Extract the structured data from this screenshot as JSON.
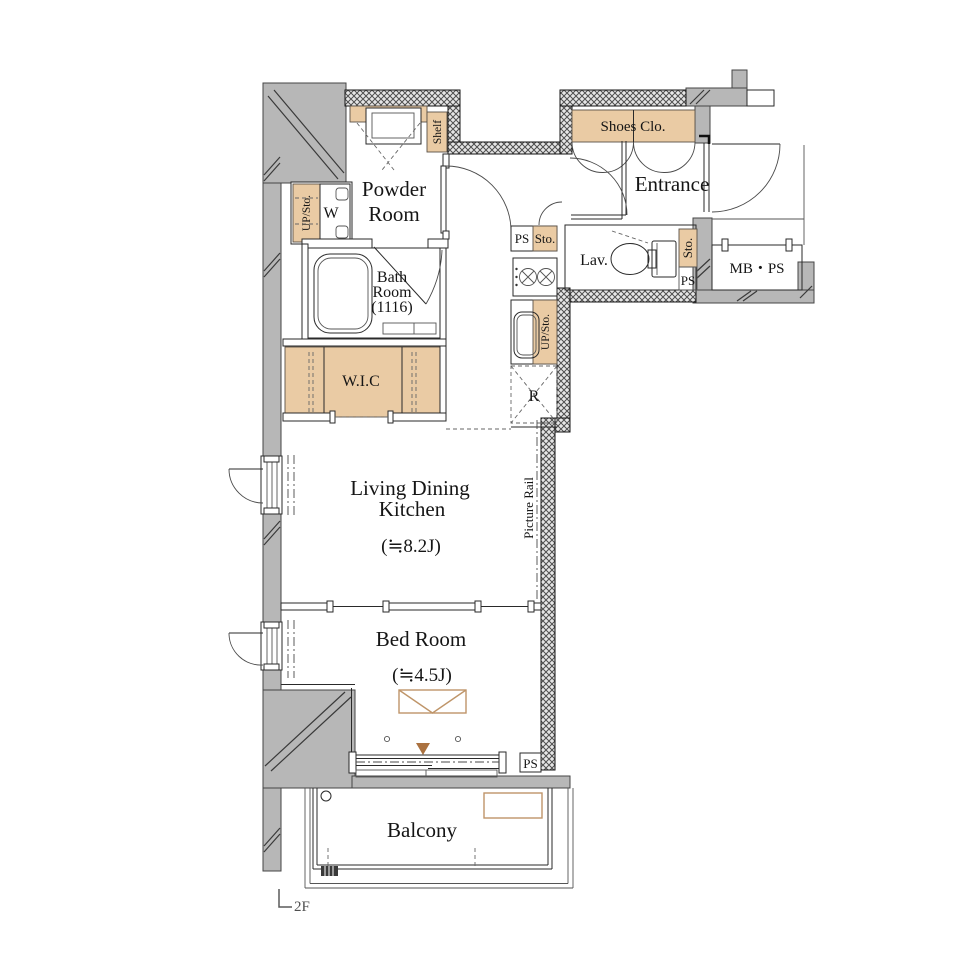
{
  "plan": {
    "floor_label": "2F",
    "rooms": {
      "powder": {
        "l1": "Powder",
        "l2": "Room"
      },
      "bath": {
        "l1": "Bath",
        "l2": "Room",
        "l3": "(1116)"
      },
      "wic": {
        "label": "W.I.C"
      },
      "ldk": {
        "l1": "Living Dining",
        "l2": "Kitchen",
        "size": "(≒8.2J)"
      },
      "bed": {
        "label": "Bed Room",
        "size": "(≒4.5J)"
      },
      "balcony": {
        "label": "Balcony"
      },
      "entrance": {
        "label": "Entrance"
      },
      "lav": {
        "label": "Lav."
      },
      "shoes": {
        "label": "Shoes Clo."
      },
      "mbps": {
        "label": "MB・PS"
      }
    },
    "fixtures": {
      "shelf": "Shelf",
      "laundry_storage": "UP/Sto.",
      "washer": "W",
      "kitchen_ps": "PS",
      "kitchen_sto": "Sto.",
      "kitchen_storage": "UP/Sto.",
      "fridge": "R",
      "lav_sto": "Sto.",
      "lav_ps": "PS",
      "bed_ps": "PS",
      "picture_rail": "Picture Rail"
    },
    "colors": {
      "wall_gray": "#b7b7b7",
      "hatch_wall": "#e6e6e6",
      "accent_beige": "#eacba4",
      "outline": "#2a2a2a",
      "tan_outline": "#bf9569",
      "triangle_brown": "#ab7240"
    }
  }
}
